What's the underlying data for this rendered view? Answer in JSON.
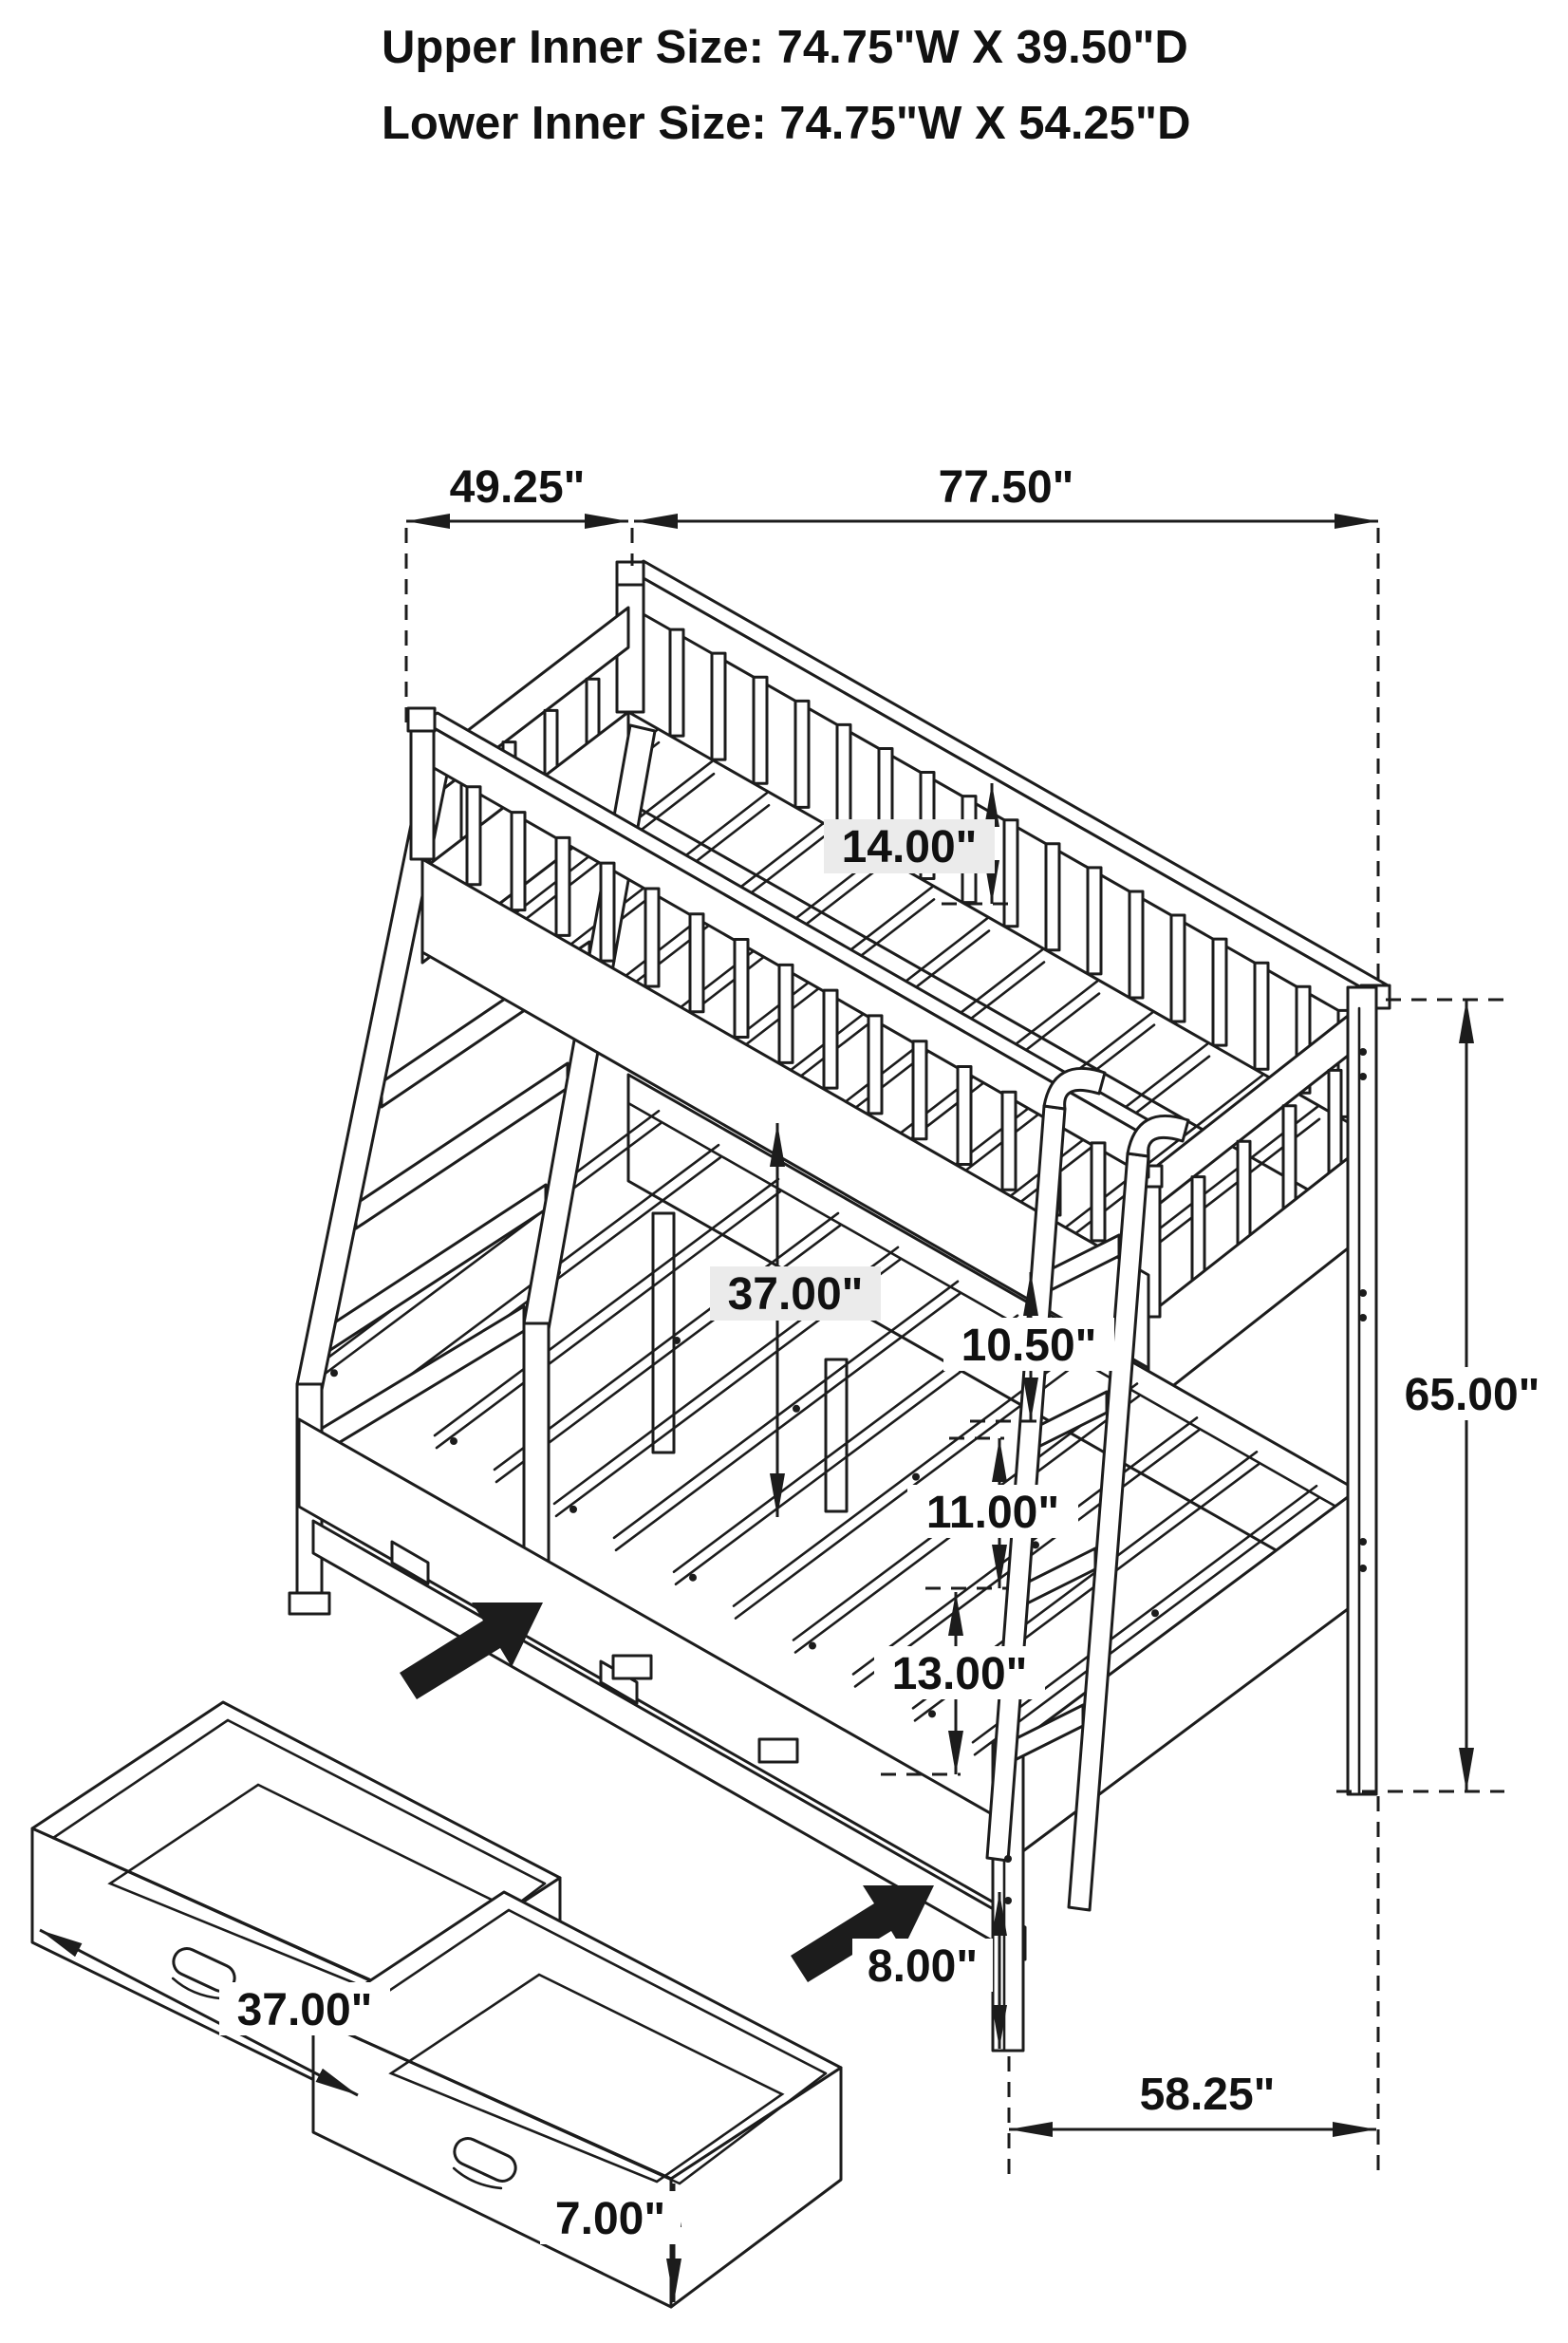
{
  "diagram_title": {
    "line1": "Upper Inner Size: 74.75\"W X 39.50\"D",
    "line2": "Lower Inner Size: 74.75\"W X 54.25\"D"
  },
  "dimensions": {
    "upper_bunk_width": "49.25\"",
    "overall_length": "77.50\"",
    "guardrail_height": "14.00\"",
    "bunk_to_bunk_clearance": "37.00\"",
    "ladder_step_top": "10.50\"",
    "ladder_step_middle": "11.00\"",
    "ladder_step_bottom": "13.00\"",
    "overall_height": "65.00\"",
    "under_bed_clearance": "8.00\"",
    "lower_bunk_depth": "58.25\"",
    "drawer_width": "37.00\"",
    "drawer_height": "7.00\""
  },
  "colors": {
    "line": "#1c1c1c",
    "label_background": "#ebebeb",
    "page_background": "#ffffff"
  }
}
